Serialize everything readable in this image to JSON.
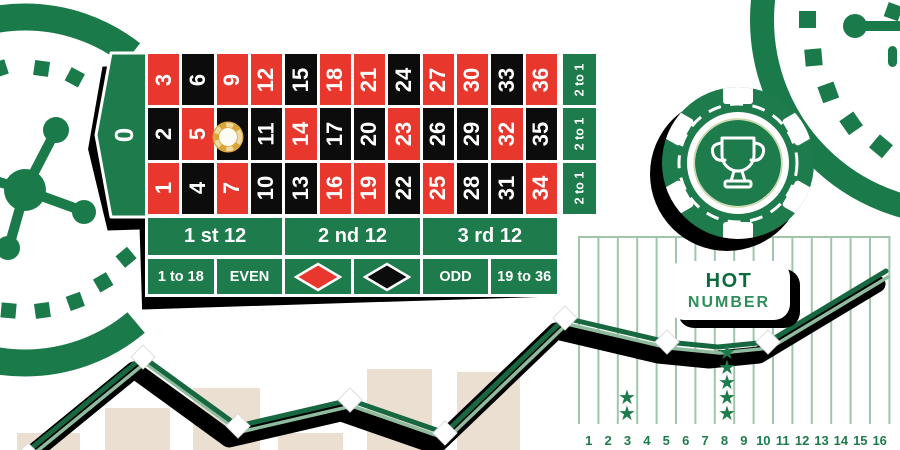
{
  "palette": {
    "green": "#1e7b4c",
    "decor_green": "#1b7a4a",
    "red": "#e8372c",
    "black": "#0c0c0c",
    "beige": "#ebdfd2",
    "grid_green": "#9fc5ab",
    "line_dark": "#176740",
    "line_light": "#8fbc9e",
    "star_green": "#1e7b4c",
    "label_green": "#1e7b4c",
    "gold": "#d9a438",
    "badge_hot": "#0c6b3d",
    "badge_number": "#2f8e5a"
  },
  "table": {
    "zero_label": "0",
    "rows": [
      [
        "3",
        "6",
        "9",
        "12",
        "15",
        "18",
        "21",
        "24",
        "27",
        "30",
        "33",
        "36"
      ],
      [
        "2",
        "5",
        "8",
        "11",
        "14",
        "17",
        "20",
        "23",
        "26",
        "29",
        "32",
        "35"
      ],
      [
        "1",
        "4",
        "7",
        "10",
        "13",
        "16",
        "19",
        "22",
        "25",
        "28",
        "31",
        "34"
      ]
    ],
    "red_numbers": [
      "1",
      "3",
      "5",
      "7",
      "9",
      "12",
      "14",
      "16",
      "18",
      "19",
      "21",
      "23",
      "25",
      "27",
      "30",
      "32",
      "34",
      "36"
    ],
    "column_bets": [
      "2 to 1",
      "2 to 1",
      "2 to 1"
    ],
    "dozen_bets": [
      "1 st 12",
      "2 nd 12",
      "3 rd 12"
    ],
    "outside_bets": [
      {
        "label": "1 to 18"
      },
      {
        "label": "EVEN"
      },
      {
        "diamond": "red"
      },
      {
        "diamond": "black"
      },
      {
        "label": "ODD"
      },
      {
        "label": "19 to 36"
      }
    ],
    "chip_on_number": "8"
  },
  "badge": {
    "line1": "HOT",
    "line2": "NUMBER"
  },
  "chip": {
    "icon": "trophy-icon"
  },
  "chart_data": {
    "type": "line",
    "title": "",
    "x_tick_labels": [
      "1",
      "2",
      "3",
      "4",
      "5",
      "6",
      "7",
      "8",
      "9",
      "10",
      "11",
      "12",
      "13",
      "14",
      "15",
      "16"
    ],
    "hot_number_stars": {
      "3": 2,
      "8": 5
    },
    "star_glyph": "★",
    "marker": "diamond",
    "grid_px": {
      "x0": 579,
      "spacing": 19.4,
      "count": 17,
      "y_top": 237,
      "y_bottom": 424
    },
    "labels_y_px": 445,
    "bars_px": [
      [
        17,
        433,
        63
      ],
      [
        105,
        408,
        65
      ],
      [
        193,
        388,
        67
      ],
      [
        278,
        433,
        65
      ],
      [
        367,
        369,
        65
      ],
      [
        457,
        372,
        63
      ]
    ],
    "line_points_px": [
      [
        28,
        451
      ],
      [
        143,
        357
      ],
      [
        238,
        426
      ],
      [
        350,
        400
      ],
      [
        445,
        433
      ],
      [
        565,
        318
      ],
      [
        667,
        342
      ],
      [
        718,
        347
      ],
      [
        768,
        342
      ],
      [
        886,
        271
      ]
    ],
    "diamond_points_px": [
      [
        28,
        450,
        10
      ],
      [
        143,
        357,
        17
      ],
      [
        238,
        426,
        17
      ],
      [
        350,
        400,
        17
      ],
      [
        445,
        433,
        17
      ],
      [
        565,
        318,
        17
      ],
      [
        667,
        342,
        17
      ],
      [
        768,
        342,
        17
      ]
    ],
    "stars": [
      {
        "number": "3",
        "x": 627,
        "ys": [
          397,
          413
        ]
      },
      {
        "number": "8",
        "x": 727,
        "ys": [
          352,
          367,
          382,
          397,
          413
        ]
      }
    ]
  }
}
